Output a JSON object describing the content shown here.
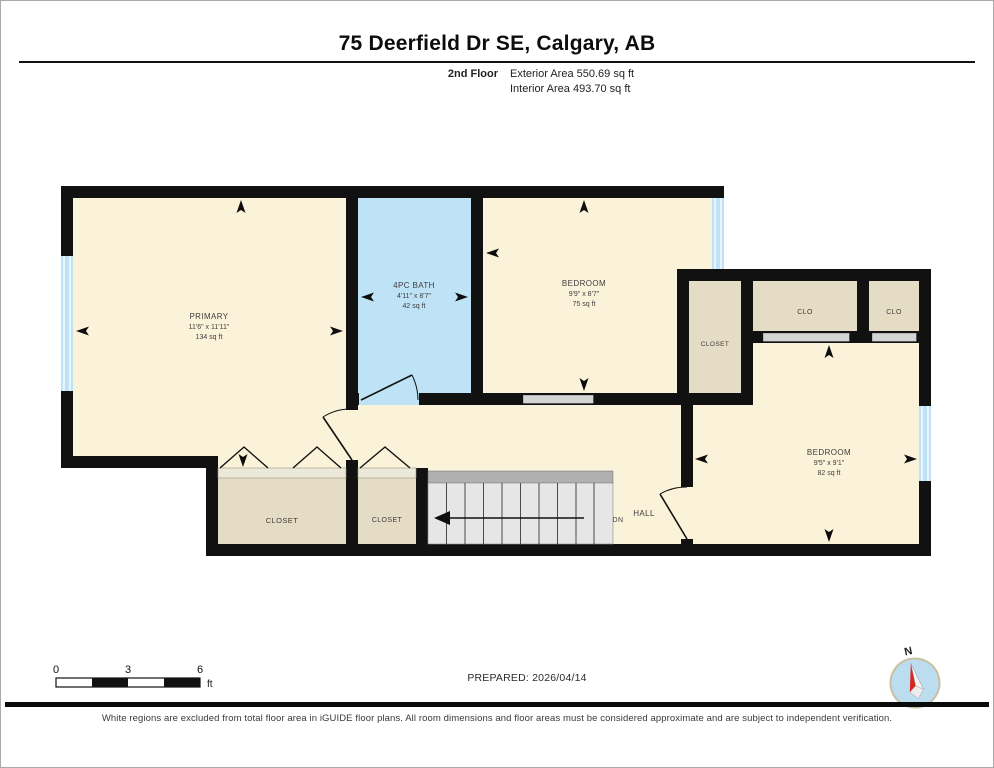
{
  "header": {
    "title": "75 Deerfield Dr SE, Calgary, AB",
    "floor_label": "2nd Floor",
    "exterior_area": "Exterior Area 550.69 sq ft",
    "interior_area": "Interior Area 493.70 sq ft"
  },
  "rooms": {
    "primary": {
      "name": "PRIMARY",
      "dims": "11'6\" x 11'11\"",
      "area": "134 sq ft"
    },
    "bath": {
      "name": "4PC BATH",
      "dims": "4'11\" x 8'7\"",
      "area": "42 sq ft"
    },
    "bedroom_top": {
      "name": "BEDROOM",
      "dims": "9'9\" x 8'7\"",
      "area": "75 sq ft"
    },
    "bedroom_right": {
      "name": "BEDROOM",
      "dims": "9'5\" x 9'1\"",
      "area": "82 sq ft"
    },
    "closet_mid": {
      "name": "CLOSET"
    },
    "clo_1": {
      "name": "CLO"
    },
    "clo_2": {
      "name": "CLO"
    },
    "closet_bottom_1": {
      "name": "CLOSET"
    },
    "closet_bottom_2": {
      "name": "CLOSET"
    },
    "hall": {
      "name": "HALL"
    },
    "stairs": {
      "label": "DN"
    }
  },
  "scale_bar": {
    "ticks": [
      "0",
      "3",
      "6"
    ],
    "unit": "ft"
  },
  "compass": {
    "north_label": "N"
  },
  "footer": {
    "prepared": "PREPARED: 2026/04/14",
    "disclaimer": "White regions are excluded from total floor area in iGUIDE floor plans. All room dimensions and floor areas must be considered approximate and are subject to independent verification."
  },
  "colors": {
    "room_fill": "#FBF3D9",
    "closet_fill": "#E5DCC5",
    "bath_fill": "#BEE3F6",
    "window_fill": "#BEE3F6",
    "wall": "#111111",
    "compass_face": "#BCDDEF",
    "compass_needle": "#D9251D"
  }
}
